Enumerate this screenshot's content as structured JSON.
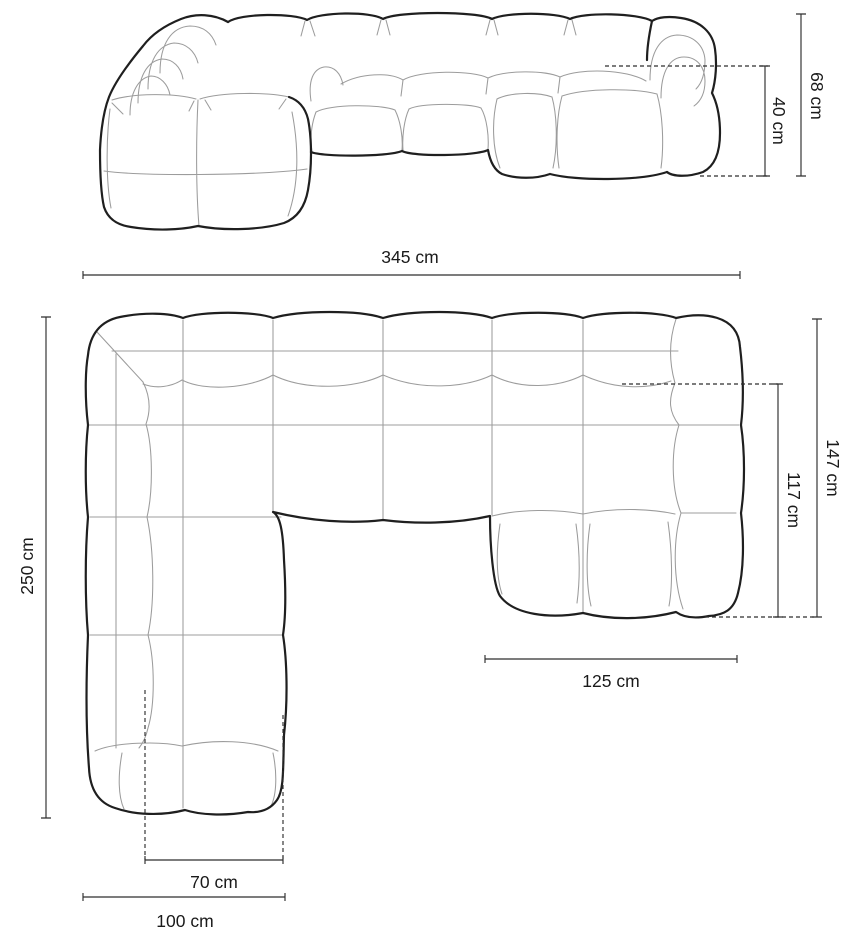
{
  "colors": {
    "outline": "#1f1f1f",
    "inner_line": "#9c9c9c",
    "dimension_line": "#2e2e2e",
    "label_text": "#1a1a1a",
    "background": "#ffffff"
  },
  "front_view": {
    "width_total_label": "345 cm",
    "height_total_label": "68 cm",
    "height_armrest_label": "40 cm"
  },
  "top_view": {
    "depth_total_label": "250 cm",
    "chaise_depth_outer_label": "147 cm",
    "chaise_depth_inner_label": "117 cm",
    "chaise_width_label": "125 cm",
    "front_seat_width_label": "70 cm",
    "side_section_width_label": "100 cm"
  }
}
